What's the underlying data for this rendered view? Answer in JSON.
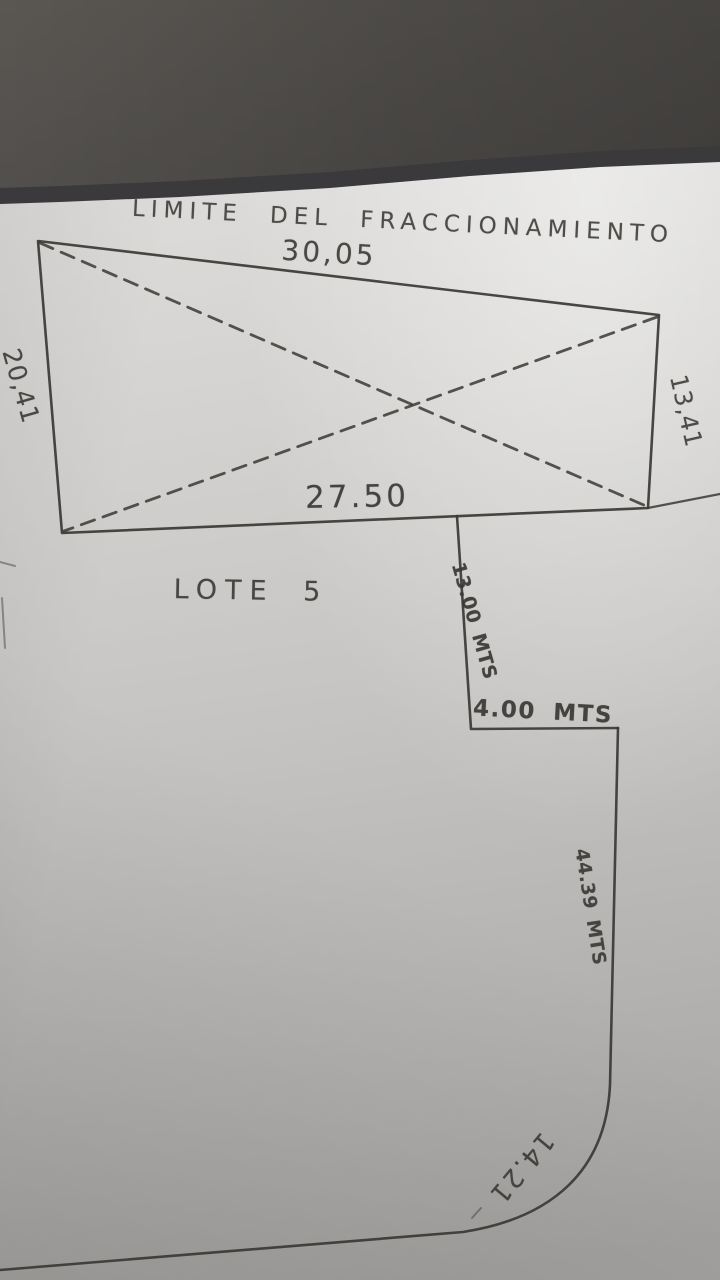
{
  "drawing": {
    "title": "LIMITE DEL FRACCIONAMIENTO",
    "lot_label": "LOTE 5",
    "dims": {
      "top": "30,05",
      "left": "20,41",
      "right": "13,41",
      "bottom_inner": "27.50",
      "step_vertical": "13.00 MTS",
      "step_horizontal": "4.00 MTS",
      "east_side": "44.39 MTS",
      "curve": "14.21"
    },
    "colors": {
      "ink": "#3a3835",
      "paper": "#c9c7c5",
      "top_band": "#3b3a3c"
    }
  }
}
